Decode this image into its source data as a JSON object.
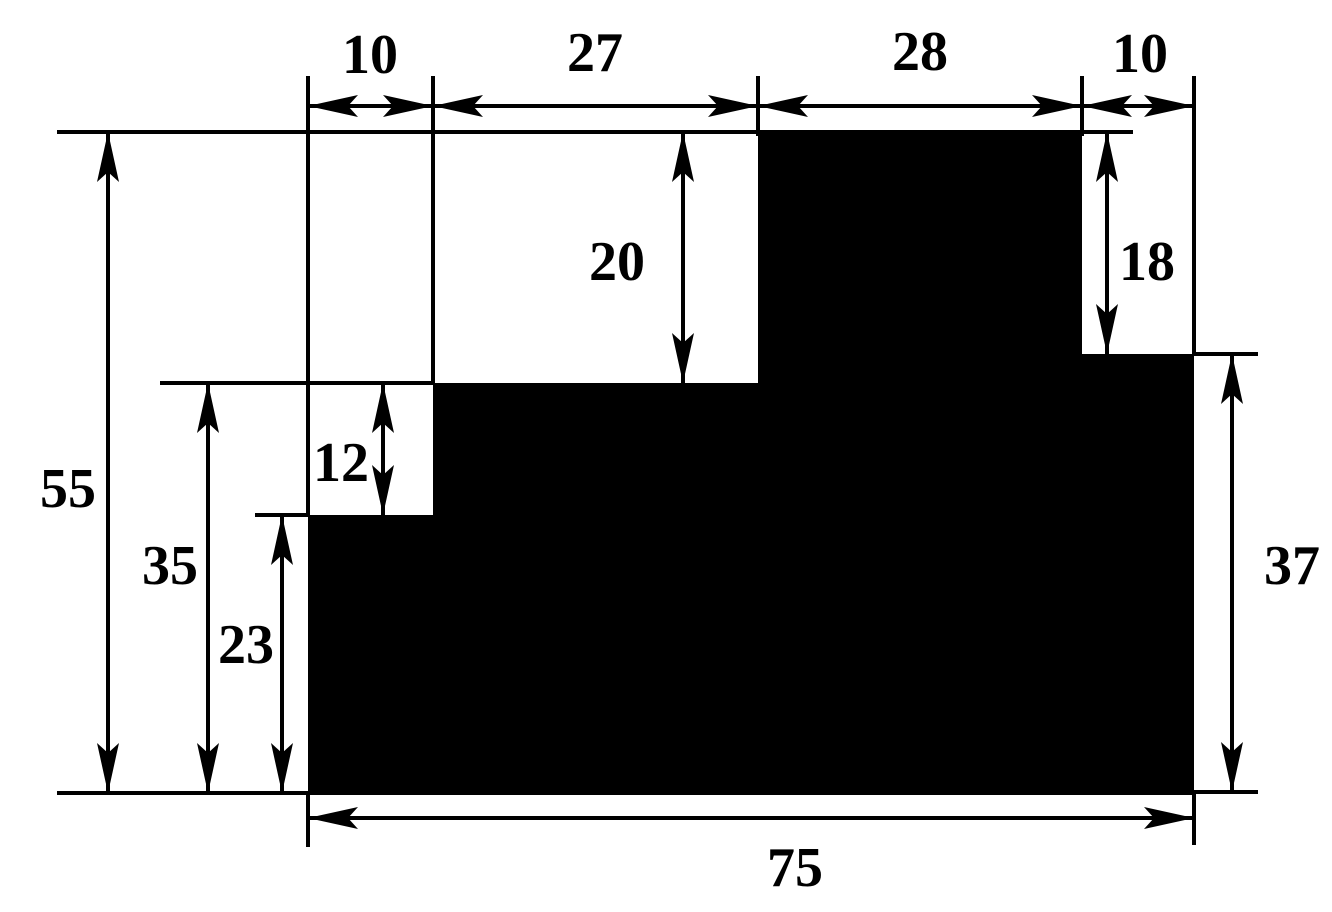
{
  "drawing": {
    "name": "stepped-block-dimension-drawing",
    "canvas": {
      "width": 1332,
      "height": 912
    },
    "colors": {
      "ink": "#000000",
      "background": "#ffffff"
    },
    "shape": {
      "name": "stepped-block",
      "fill": "#000000",
      "points_px": [
        [
          308,
          793
        ],
        [
          308,
          515
        ],
        [
          433,
          515
        ],
        [
          433,
          383
        ],
        [
          758,
          383
        ],
        [
          758,
          132
        ],
        [
          1082,
          132
        ],
        [
          1082,
          354
        ],
        [
          1194,
          354
        ],
        [
          1194,
          793
        ]
      ]
    },
    "unit_profile": {
      "top_segments": [
        10,
        27,
        28,
        10
      ],
      "column_heights": [
        23,
        35,
        55,
        37
      ],
      "total_width": 75,
      "total_height": 55,
      "notch_heights": {
        "upper_notch": 20,
        "left_step": 12,
        "right_step": 18
      }
    },
    "dimensions": [
      {
        "id": "dim-top-10-left",
        "value": "10",
        "orientation": "h",
        "x1": 308,
        "x2": 433,
        "y": 106,
        "label": {
          "x": 370,
          "y": 55
        }
      },
      {
        "id": "dim-top-27",
        "value": "27",
        "orientation": "h",
        "x1": 433,
        "x2": 758,
        "y": 106,
        "label": {
          "x": 595,
          "y": 53
        }
      },
      {
        "id": "dim-top-28",
        "value": "28",
        "orientation": "h",
        "x1": 758,
        "x2": 1082,
        "y": 106,
        "label": {
          "x": 920,
          "y": 52
        }
      },
      {
        "id": "dim-top-10-right",
        "value": "10",
        "orientation": "h",
        "x1": 1082,
        "x2": 1194,
        "y": 106,
        "label": {
          "x": 1140,
          "y": 54
        }
      },
      {
        "id": "dim-55",
        "value": "55",
        "orientation": "v",
        "y1": 132,
        "y2": 793,
        "x": 108,
        "label": {
          "x": 68,
          "y": 489
        }
      },
      {
        "id": "dim-35",
        "value": "35",
        "orientation": "v",
        "y1": 383,
        "y2": 793,
        "x": 208,
        "label": {
          "x": 170,
          "y": 566
        }
      },
      {
        "id": "dim-23",
        "value": "23",
        "orientation": "v",
        "y1": 515,
        "y2": 793,
        "x": 282,
        "label": {
          "x": 246,
          "y": 645
        }
      },
      {
        "id": "dim-12",
        "value": "12",
        "orientation": "v",
        "y1": 383,
        "y2": 515,
        "x": 383,
        "label": {
          "x": 341,
          "y": 463
        }
      },
      {
        "id": "dim-20",
        "value": "20",
        "orientation": "v",
        "y1": 132,
        "y2": 383,
        "x": 683,
        "label": {
          "x": 617,
          "y": 262
        }
      },
      {
        "id": "dim-18",
        "value": "18",
        "orientation": "v",
        "y1": 132,
        "y2": 354,
        "x": 1107,
        "label": {
          "x": 1147,
          "y": 262
        }
      },
      {
        "id": "dim-37",
        "value": "37",
        "orientation": "v",
        "y1": 354,
        "y2": 792,
        "x": 1232,
        "label": {
          "x": 1292,
          "y": 566
        }
      },
      {
        "id": "dim-bottom-75",
        "value": "75",
        "orientation": "h",
        "x1": 308,
        "x2": 1194,
        "y": 818,
        "label": {
          "x": 795,
          "y": 868
        }
      }
    ],
    "extension_lines": [
      {
        "id": "ext-top-edge",
        "x1": 57,
        "y1": 132,
        "x2": 1133,
        "y2": 132
      },
      {
        "id": "ext-bottom-edge",
        "x1": 57,
        "y1": 793,
        "x2": 1194,
        "y2": 793
      },
      {
        "id": "ext-mid-band-top",
        "x1": 160,
        "y1": 383,
        "x2": 433,
        "y2": 383
      },
      {
        "id": "ext-low-left-top",
        "x1": 255,
        "y1": 515,
        "x2": 308,
        "y2": 515
      },
      {
        "id": "ext-right-step-top",
        "x1": 1194,
        "y1": 354,
        "x2": 1258,
        "y2": 354
      },
      {
        "id": "ext-right-bottom",
        "x1": 1194,
        "y1": 792,
        "x2": 1258,
        "y2": 792
      },
      {
        "id": "ext-v-left-outer",
        "x1": 308,
        "y1": 76,
        "x2": 308,
        "y2": 515
      },
      {
        "id": "ext-v-mid-left",
        "x1": 433,
        "y1": 76,
        "x2": 433,
        "y2": 383
      },
      {
        "id": "ext-v-block-left",
        "x1": 758,
        "y1": 76,
        "x2": 758,
        "y2": 136
      },
      {
        "id": "ext-v-block-right",
        "x1": 1082,
        "y1": 76,
        "x2": 1082,
        "y2": 136
      },
      {
        "id": "ext-v-right-outer",
        "x1": 1194,
        "y1": 76,
        "x2": 1194,
        "y2": 354
      },
      {
        "id": "ext-v-left-below",
        "x1": 308,
        "y1": 793,
        "x2": 308,
        "y2": 847
      },
      {
        "id": "ext-v-right-below",
        "x1": 1194,
        "y1": 790,
        "x2": 1194,
        "y2": 845
      }
    ]
  }
}
